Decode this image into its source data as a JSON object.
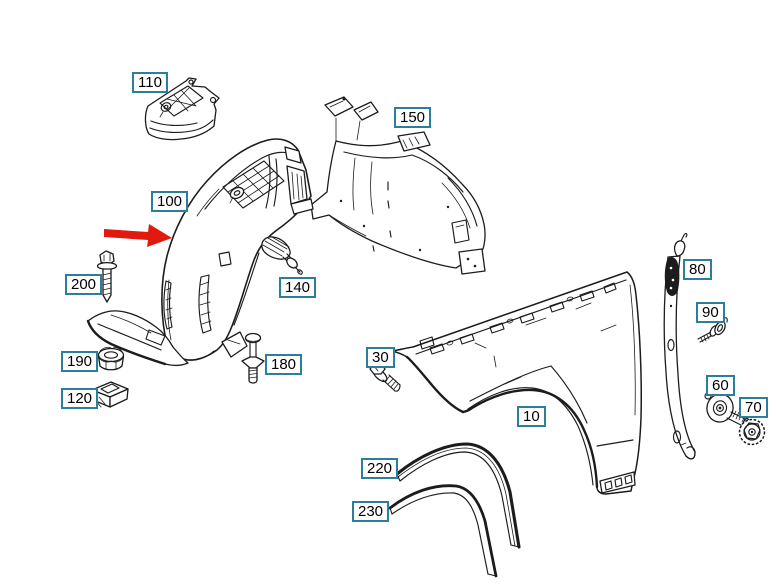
{
  "page": {
    "background": "#ffffff"
  },
  "diagram": {
    "type": "exploded-parts-diagram",
    "line_color": "#1c1c1c",
    "label_border_color": "#2b7f9d",
    "label_fill_color": "#ffffff",
    "label_text_color": "#000000",
    "arrow_color": "#e2190f",
    "callouts": [
      {
        "id": "110"
      },
      {
        "id": "150"
      },
      {
        "id": "100",
        "highlighted": true
      },
      {
        "id": "140"
      },
      {
        "id": "200"
      },
      {
        "id": "190"
      },
      {
        "id": "120"
      },
      {
        "id": "180"
      },
      {
        "id": "30"
      },
      {
        "id": "10"
      },
      {
        "id": "220"
      },
      {
        "id": "230"
      },
      {
        "id": "80"
      },
      {
        "id": "90"
      },
      {
        "id": "60"
      },
      {
        "id": "70"
      }
    ]
  }
}
